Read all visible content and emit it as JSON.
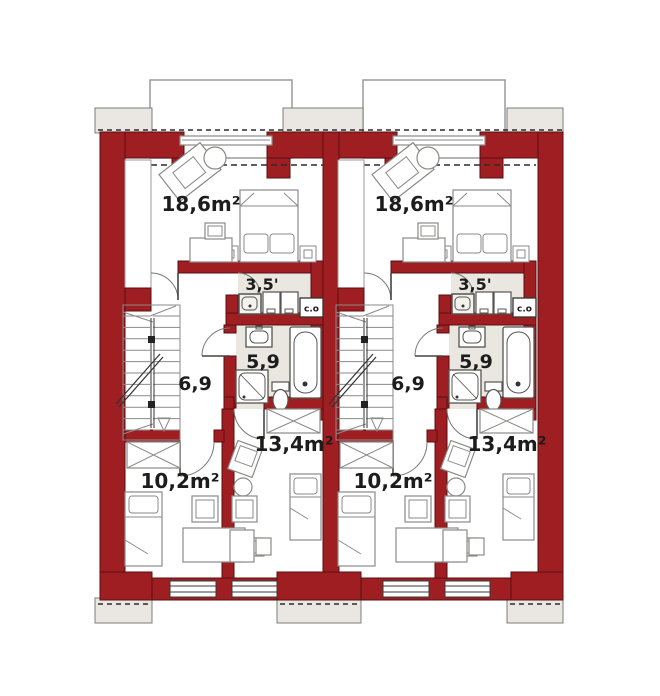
{
  "plan": {
    "colors": {
      "background": "#ffffff",
      "wall_fill": "#9e1e22",
      "wall_stroke": "#5a0f12",
      "room_fill": "#eae6e0",
      "eave_fill": "#eae7e2",
      "outline_gray": "#9a9a98",
      "furniture_stroke": "#8a8a88",
      "fixture_stroke": "#55544f",
      "dash_color": "#2b2b2b",
      "text_color": "#1c1c1c"
    },
    "units": [
      {
        "id": "unit-left",
        "rooms": {
          "bedroom_large": "18,6m²",
          "utility": "3,5'",
          "bathroom": "5,9",
          "hallway": "6,9",
          "bedroom_small": "10,2m²",
          "bedroom_medium": "13,4m²",
          "boiler": "c.o"
        }
      },
      {
        "id": "unit-right",
        "rooms": {
          "bedroom_large": "18,6m²",
          "utility": "3,5'",
          "bathroom": "5,9",
          "hallway": "6,9",
          "bedroom_small": "10,2m²",
          "bedroom_medium": "13,4m²",
          "boiler": "c.o"
        }
      }
    ]
  }
}
